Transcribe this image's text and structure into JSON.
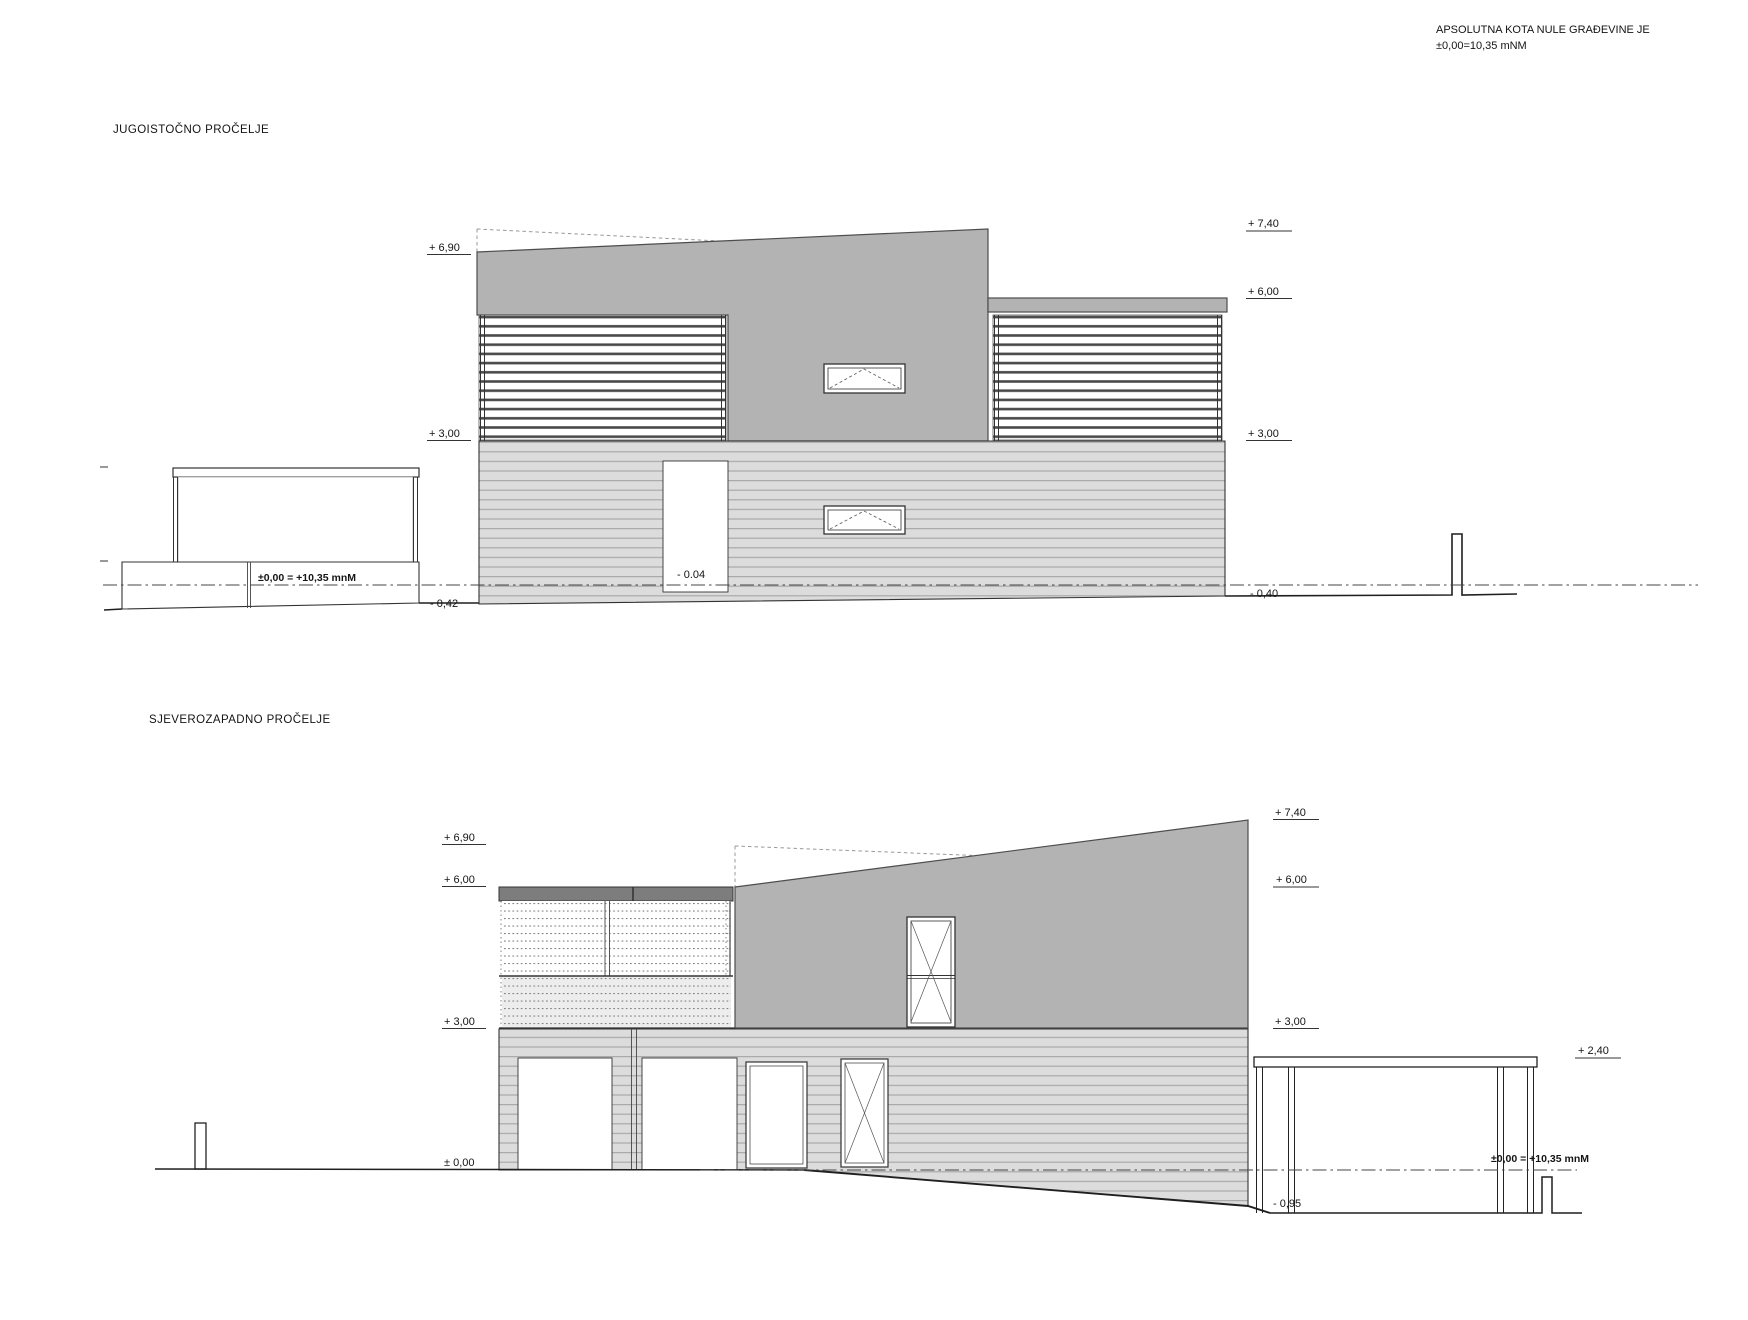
{
  "note": {
    "line1": "APSOLUTNA KOTA NULE GRAĐEVINE JE",
    "line2": "±0,00=10,35 mNM"
  },
  "se": {
    "title": "JUGOISTOČNO PROČELJE",
    "dim_690": "+ 6,90",
    "dim_300_left": "+ 3,00",
    "dim_740": "+ 7,40",
    "dim_600": "+ 6,00",
    "dim_300_right": "+ 3,00",
    "minus_040": "- 0,40",
    "datum_text": "±0,00 = +10,35 mnM",
    "minus_042": "- 0,42",
    "minus_004": "- 0.04"
  },
  "nw": {
    "title": "SJEVEROZAPADNO PROČELJE",
    "dim_690": "+ 6,90",
    "dim_600_left": "+ 6,00",
    "dim_300_left": "+ 3,00",
    "dim_000": "± 0,00",
    "dim_740": "+ 7,40",
    "dim_600_right": "+ 6,00",
    "dim_300_right": "+ 3,00",
    "dim_240": "+ 2,40",
    "datum_text": "±0,00 = +10,35 mnM",
    "minus_095": "- 0,95"
  },
  "colors": {
    "upper_wall_gray": "#b3b3b3",
    "flat_roof_dark_gray": "#7d7d7d",
    "siding_light_gray": "#dcdcdc",
    "siding_stripe_gray": "#a9a9a9",
    "drawing_line": "#333333"
  }
}
